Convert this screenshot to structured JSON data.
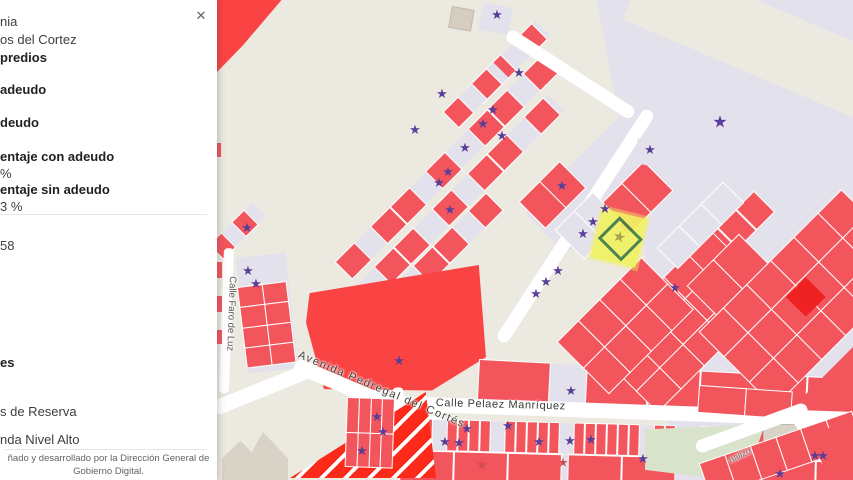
{
  "panel": {
    "close_label": "✕",
    "colonia_fragment": "nia",
    "colonia_name": "os del Cortez",
    "predios_heading": "predios",
    "con_adeudo_label": "adeudo",
    "sin_adeudo_label": "deudo",
    "pct_con_label": "entaje con adeudo",
    "pct_con_value": "%",
    "pct_sin_label": "entaje sin adeudo",
    "pct_sin_value": "3 %",
    "count_fragment": "58",
    "section_heading_fragment": "es",
    "legend_reserva": "s de Reserva",
    "legend_vivienda": "nda Nivel Alto",
    "footer_line1": "ñado y desarrollado por la Dirección General de",
    "footer_line2": "Gobierno Digital."
  },
  "map": {
    "streets": {
      "faro": "Calle Faro de Luz",
      "avenida": "Avenida Pedregal del Cortés",
      "pelaez": "Calle Pelaez Manríquez",
      "canalizo": "nalizo"
    },
    "selected_star": "★",
    "star_glyph": "★",
    "palette": {
      "bg": "#ece9e1",
      "lav": "#e3e2ec",
      "red": "#f3555d",
      "vivid": "#fa4343",
      "stripe": "#fb2a1a",
      "white": "#ffffff",
      "gray": "#d9d3c7",
      "grayb": "#c1bab0",
      "green": "#d9e3cc",
      "tan": "#d5cdbf",
      "yellow": "#f1f262",
      "olive": "#a79a42",
      "purple": "#5a3d96",
      "faded": "#d4494f",
      "deep": "#ee2222"
    },
    "shapes": [
      {
        "c": "lav",
        "x": 555,
        "y": 0,
        "w": 298,
        "h": 470,
        "clip": "polygon(14% 0,100% 0,100% 100%,40% 100%,33% 64%)"
      },
      {
        "c": "bg",
        "x": 650,
        "y": -45,
        "w": 430,
        "h": 70,
        "r": 23
      },
      {
        "c": "vivid",
        "x": 215,
        "y": 0,
        "w": 70,
        "h": 78,
        "clip": "polygon(0 0,95% 0,40% 58%,0 95%)"
      },
      {
        "c": "tan",
        "x": 452,
        "y": 6,
        "w": 21,
        "h": 20,
        "r": 10,
        "bd": "grayb"
      },
      {
        "c": "lav",
        "x": 484,
        "y": 2,
        "w": 30,
        "h": 28,
        "r": 12
      },
      {
        "c": "lav",
        "x": 524,
        "y": 212,
        "w": 148,
        "h": 60,
        "r": -45,
        "rad": 6
      },
      {
        "c": "lav",
        "x": 336,
        "y": 262,
        "w": 285,
        "h": 23,
        "r": -45,
        "cells": [
          {
            "w": 26,
            "c": "r"
          },
          {
            "w": 20,
            "c": "e"
          },
          {
            "w": 26,
            "c": "r"
          },
          {
            "w": 26,
            "c": "r"
          },
          {
            "w": 20,
            "c": "e"
          },
          {
            "w": 26,
            "c": "r"
          },
          {
            "w": 30,
            "c": "e"
          },
          {
            "w": 26,
            "c": "r"
          },
          {
            "w": 26,
            "c": "r"
          },
          {
            "w": 20,
            "c": "e"
          },
          {
            "w": 26,
            "c": "r"
          }
        ]
      },
      {
        "c": "lav",
        "x": 358,
        "y": 284,
        "w": 268,
        "h": 23,
        "r": -45,
        "cells": [
          {
            "w": 22,
            "c": "e"
          },
          {
            "w": 26,
            "c": "r"
          },
          {
            "w": 26,
            "c": "r"
          },
          {
            "w": 24,
            "c": "e"
          },
          {
            "w": 26,
            "c": "r"
          },
          {
            "w": 20,
            "c": "e"
          },
          {
            "w": 26,
            "c": "r"
          },
          {
            "w": 26,
            "c": "r"
          },
          {
            "w": 22,
            "c": "e"
          },
          {
            "w": 26,
            "c": "r"
          }
        ]
      },
      {
        "c": "lav",
        "x": 380,
        "y": 300,
        "w": 150,
        "h": 23,
        "r": -45,
        "cells": [
          {
            "w": 24,
            "c": "r"
          },
          {
            "w": 20,
            "c": "e"
          },
          {
            "w": 26,
            "c": "r"
          },
          {
            "w": 26,
            "c": "r"
          },
          {
            "w": 20,
            "c": "e"
          },
          {
            "w": 24,
            "c": "r"
          }
        ]
      },
      {
        "c": "lav",
        "x": 468,
        "y": 88,
        "w": 95,
        "h": 21,
        "r": -45,
        "cells": [
          {
            "w": 22,
            "c": "r"
          },
          {
            "w": 22,
            "c": "r"
          },
          {
            "w": 18,
            "c": "e"
          },
          {
            "w": 22,
            "c": "r"
          }
        ]
      },
      {
        "c": "lav",
        "x": 444,
        "y": 112,
        "w": 70,
        "h": 21,
        "r": -45,
        "cells": [
          {
            "w": 20,
            "c": "r"
          },
          {
            "w": 16,
            "c": "e"
          },
          {
            "w": 20,
            "c": "r"
          }
        ]
      },
      {
        "c": "lav",
        "x": 210,
        "y": 245,
        "w": 60,
        "h": 19,
        "r": -45,
        "cells": [
          {
            "w": 16,
            "c": "r"
          },
          {
            "w": 12,
            "c": "e"
          },
          {
            "w": 16,
            "c": "r"
          }
        ]
      },
      {
        "c": "white",
        "x": 511,
        "y": 28,
        "w": 150,
        "h": 13,
        "r": 33,
        "rad": 8
      },
      {
        "c": "white",
        "x": 495,
        "y": 338,
        "w": 275,
        "h": 13,
        "r": -57,
        "rad": 8
      },
      {
        "c": "white",
        "x": 224,
        "y": 248,
        "w": 10,
        "h": 145,
        "r": 2,
        "rad": 4
      },
      {
        "c": "lav",
        "x": 236,
        "y": 258,
        "w": 50,
        "h": 116,
        "r": -6
      },
      {
        "c": "lav",
        "x": 238,
        "y": 288,
        "w": 48,
        "h": 80,
        "r": -7,
        "grid": {
          "rows": 4,
          "cols": 2
        },
        "fill": "red"
      },
      {
        "c": "red",
        "x": 214,
        "y": 143,
        "w": 7,
        "h": 14
      },
      {
        "c": "red",
        "x": 214,
        "y": 262,
        "w": 8,
        "h": 16
      },
      {
        "c": "red",
        "x": 214,
        "y": 296,
        "w": 8,
        "h": 16
      },
      {
        "c": "red",
        "x": 214,
        "y": 330,
        "w": 8,
        "h": 14
      },
      {
        "c": "vivid",
        "x": 306,
        "y": 265,
        "w": 180,
        "h": 128,
        "clip": "polygon(2% 22%,96% 0,100% 72%,70% 98%,10% 97%,0 45%)"
      },
      {
        "c": "lav",
        "x": 480,
        "y": 360,
        "w": 376,
        "h": 42,
        "r": 3,
        "cells": [
          {
            "w": 70,
            "c": "r"
          },
          {
            "w": 34,
            "c": "e"
          },
          {
            "w": 60,
            "c": "r"
          },
          {
            "w": 50,
            "c": "r"
          },
          {
            "w": 55,
            "c": "r"
          },
          {
            "w": 48,
            "c": "r"
          },
          {
            "w": 55,
            "c": "r"
          }
        ]
      },
      {
        "c": "lav",
        "x": 628,
        "y": 318,
        "w": 195,
        "h": 28,
        "r": -45,
        "cells": [
          {
            "w": 24,
            "c": "r"
          },
          {
            "w": 24,
            "c": "r"
          },
          {
            "w": 22,
            "c": "e"
          },
          {
            "w": 24,
            "c": "r"
          },
          {
            "w": 24,
            "c": "r"
          },
          {
            "w": 24,
            "c": "r"
          },
          {
            "w": 24,
            "c": "r"
          }
        ]
      },
      {
        "c": "lav",
        "x": 594,
        "y": 348,
        "w": 165,
        "h": 90,
        "r": -45,
        "grid": {
          "rows": 3,
          "cols": 5
        },
        "fill": "red"
      },
      {
        "c": "lav",
        "x": 700,
        "y": 332,
        "w": 200,
        "h": 105,
        "r": -45,
        "grid": {
          "rows": 3,
          "cols": 6
        },
        "fill": "red"
      },
      {
        "c": "deep",
        "x": 786,
        "y": 297,
        "w": 28,
        "h": 28,
        "r": -45
      },
      {
        "c": "red",
        "x": 768,
        "y": 432,
        "w": 255,
        "h": 50,
        "r": -45
      },
      {
        "c": "white",
        "x": 658,
        "y": 248,
        "w": 92,
        "h": 28,
        "r": -45,
        "grid": {
          "rows": 1,
          "cols": 3
        },
        "fill": "lav"
      },
      {
        "c": "white",
        "x": 688,
        "y": 286,
        "w": 72,
        "h": 40,
        "r": -45,
        "grid": {
          "rows": 1,
          "cols": 2
        },
        "fill": "red"
      },
      {
        "c": "white",
        "x": 558,
        "y": 342,
        "w": 118,
        "h": 72,
        "r": -45,
        "grid": {
          "rows": 2,
          "cols": 4
        },
        "fill": "red"
      },
      {
        "c": "white",
        "x": 600,
        "y": 206,
        "w": 62,
        "h": 40,
        "r": -45,
        "grid": {
          "rows": 1,
          "cols": 2
        },
        "fill": "red"
      },
      {
        "c": "white",
        "x": 520,
        "y": 202,
        "w": 56,
        "h": 36,
        "r": -45,
        "grid": {
          "rows": 1,
          "cols": 2
        },
        "fill": "red"
      },
      {
        "c": "white",
        "x": 556,
        "y": 230,
        "w": 52,
        "h": 40,
        "r": -45,
        "grid": {
          "rows": 1,
          "cols": 2
        },
        "fill": "lav"
      },
      {
        "c": "lav",
        "x": 638,
        "y": 138,
        "w": 25,
        "h": 25,
        "r": 12
      },
      {
        "c": "white",
        "x": 211,
        "y": 402,
        "w": 105,
        "h": 15,
        "r": -22,
        "rad": 6
      },
      {
        "c": "white",
        "x": 298,
        "y": 358,
        "w": 262,
        "h": 15,
        "r": 23,
        "rad": 6
      },
      {
        "c": "white",
        "x": 392,
        "y": 388,
        "w": 11,
        "h": 95,
        "r": -5,
        "rad": 4
      },
      {
        "c": "white",
        "x": 396,
        "y": 396,
        "w": 458,
        "h": 15,
        "r": 2,
        "rad": 3
      },
      {
        "c": "lav",
        "x": 401,
        "y": 419,
        "w": 300,
        "h": 30,
        "r": 1.5,
        "cells": [
          {
            "w": 9,
            "c": "r"
          },
          {
            "w": 9,
            "c": "r"
          },
          {
            "w": 9,
            "c": "r"
          },
          {
            "w": 12,
            "c": "e"
          },
          {
            "w": 9,
            "c": "r"
          },
          {
            "w": 9,
            "c": "r"
          },
          {
            "w": 9,
            "c": "r"
          },
          {
            "w": 9,
            "c": "r"
          },
          {
            "w": 12,
            "c": "e"
          },
          {
            "w": 9,
            "c": "r"
          },
          {
            "w": 9,
            "c": "r"
          },
          {
            "w": 9,
            "c": "r"
          },
          {
            "w": 9,
            "c": "r"
          },
          {
            "w": 9,
            "c": "r"
          },
          {
            "w": 12,
            "c": "e"
          },
          {
            "w": 9,
            "c": "r"
          },
          {
            "w": 9,
            "c": "r"
          },
          {
            "w": 9,
            "c": "r"
          },
          {
            "w": 9,
            "c": "r"
          },
          {
            "w": 9,
            "c": "r"
          },
          {
            "w": 9,
            "c": "r"
          },
          {
            "w": 12,
            "c": "e"
          },
          {
            "w": 9,
            "c": "r"
          },
          {
            "w": 9,
            "c": "r"
          }
        ]
      },
      {
        "c": "lav",
        "x": 702,
        "y": 427,
        "w": 152,
        "h": 27,
        "r": 2,
        "cells": [
          {
            "w": 9,
            "c": "r"
          },
          {
            "w": 9,
            "c": "r"
          },
          {
            "w": 9,
            "c": "r"
          },
          {
            "w": 9,
            "c": "r"
          },
          {
            "w": 10,
            "c": "e"
          },
          {
            "w": 9,
            "c": "r"
          },
          {
            "w": 9,
            "c": "r"
          },
          {
            "w": 9,
            "c": "r"
          },
          {
            "w": 9,
            "c": "r"
          },
          {
            "w": 9,
            "c": "r"
          },
          {
            "w": 9,
            "c": "r"
          },
          {
            "w": 9,
            "c": "r"
          }
        ]
      },
      {
        "c": "lav",
        "x": 401,
        "y": 451,
        "w": 455,
        "h": 30,
        "r": 1.5,
        "cells": [
          {
            "w": 52,
            "c": "r"
          },
          {
            "w": 52,
            "c": "r"
          },
          {
            "w": 52,
            "c": "r"
          },
          {
            "w": 4,
            "c": "e"
          },
          {
            "w": 52,
            "c": "r"
          },
          {
            "w": 52,
            "c": "r"
          },
          {
            "w": 30,
            "c": "e"
          },
          {
            "w": 52,
            "c": "r"
          },
          {
            "w": 52,
            "c": "r"
          },
          {
            "w": 52,
            "c": "r"
          }
        ]
      },
      {
        "c": "white",
        "x": 700,
        "y": 386,
        "w": 92,
        "h": 26,
        "r": 4,
        "grid": {
          "rows": 1,
          "cols": 2
        },
        "fill": "red"
      },
      {
        "c": "gray",
        "x": 222,
        "y": 432,
        "w": 66,
        "h": 48,
        "clip": "polygon(0 55%,28% 18%,45% 42%,62% 0,100% 55%,100% 100%,0 100%)"
      },
      {
        "c": "stripe",
        "x": 290,
        "y": 392,
        "w": 146,
        "h": 86,
        "clip": "polygon(93% 0,100% 100%,0 100%)",
        "grad": true
      },
      {
        "c": "lav",
        "x": 348,
        "y": 398,
        "w": 46,
        "h": 68,
        "r": 2,
        "grid": {
          "rows": 2,
          "cols": 4
        },
        "fill": "red"
      },
      {
        "c": "green",
        "x": 645,
        "y": 424,
        "w": 120,
        "h": 54,
        "clip": "polygon(0 10%,100% 0,90% 65%,55% 100%,0 85%)"
      },
      {
        "c": "gray",
        "x": 763,
        "y": 424,
        "w": 40,
        "h": 23,
        "bd": "grayb"
      },
      {
        "c": "gray",
        "x": 801,
        "y": 440,
        "w": 14,
        "h": 11,
        "bd": "grayb"
      },
      {
        "c": "white",
        "x": 790,
        "y": 418,
        "w": 12,
        "h": 75,
        "r": -35,
        "rad": 5
      },
      {
        "c": "white",
        "x": 694,
        "y": 442,
        "w": 118,
        "h": 13,
        "r": -20,
        "rad": 8
      },
      {
        "c": "lav",
        "x": 700,
        "y": 464,
        "w": 160,
        "h": 34,
        "r": -19,
        "grid": {
          "rows": 1,
          "cols": 6
        },
        "fill": "red"
      },
      {
        "c": "red",
        "x": 812,
        "y": 434,
        "w": 75,
        "h": 52,
        "r": -19
      }
    ],
    "stars": [
      [
        497,
        15
      ],
      [
        519,
        73
      ],
      [
        442,
        94
      ],
      [
        493,
        110
      ],
      [
        483,
        124
      ],
      [
        502,
        136
      ],
      [
        465,
        148
      ],
      [
        415,
        130
      ],
      [
        448,
        172
      ],
      [
        439,
        183
      ],
      [
        450,
        210
      ],
      [
        247,
        228
      ],
      [
        248,
        271
      ],
      [
        256,
        284
      ],
      [
        720,
        123,
        17
      ],
      [
        650,
        150,
        13
      ],
      [
        675,
        288
      ],
      [
        562,
        186
      ],
      [
        605,
        209
      ],
      [
        593,
        222
      ],
      [
        583,
        234
      ],
      [
        558,
        271
      ],
      [
        546,
        282
      ],
      [
        536,
        294
      ],
      [
        399,
        361
      ],
      [
        571,
        391
      ],
      [
        377,
        417
      ],
      [
        383,
        432
      ],
      [
        362,
        451
      ],
      [
        467,
        429
      ],
      [
        508,
        426
      ],
      [
        445,
        442
      ],
      [
        459,
        443
      ],
      [
        539,
        442
      ],
      [
        570,
        441
      ],
      [
        591,
        440
      ],
      [
        643,
        459
      ],
      [
        780,
        474
      ],
      [
        815,
        456
      ],
      [
        823,
        456
      ],
      [
        482,
        465,
        13,
        "faded"
      ],
      [
        563,
        463,
        12,
        "faded"
      ]
    ]
  }
}
